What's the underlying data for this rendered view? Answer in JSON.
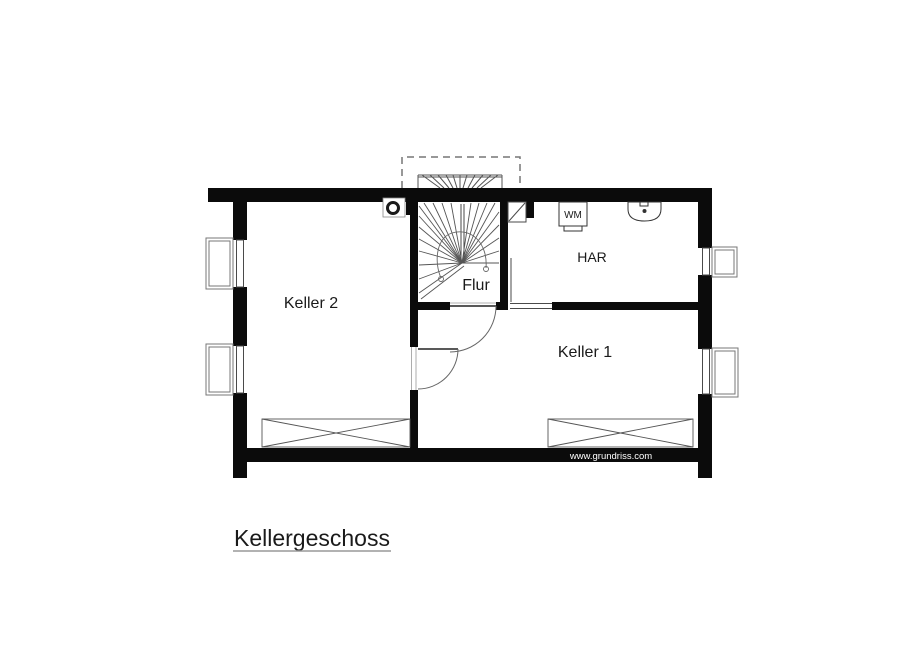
{
  "plan": {
    "title": "Kellergeschoss",
    "watermark": "www.grundriss.com",
    "rooms": {
      "keller2": "Keller 2",
      "keller1": "Keller 1",
      "flur": "Flur",
      "har": "HAR"
    },
    "appliances": {
      "washing_machine": "WM"
    },
    "colors": {
      "wall": "#0b0b0b",
      "background": "#ffffff",
      "thin_line": "#4a4a4a",
      "light_line": "#777777",
      "text": "#1a1a1a",
      "watermark_text": "#ffffff"
    }
  }
}
